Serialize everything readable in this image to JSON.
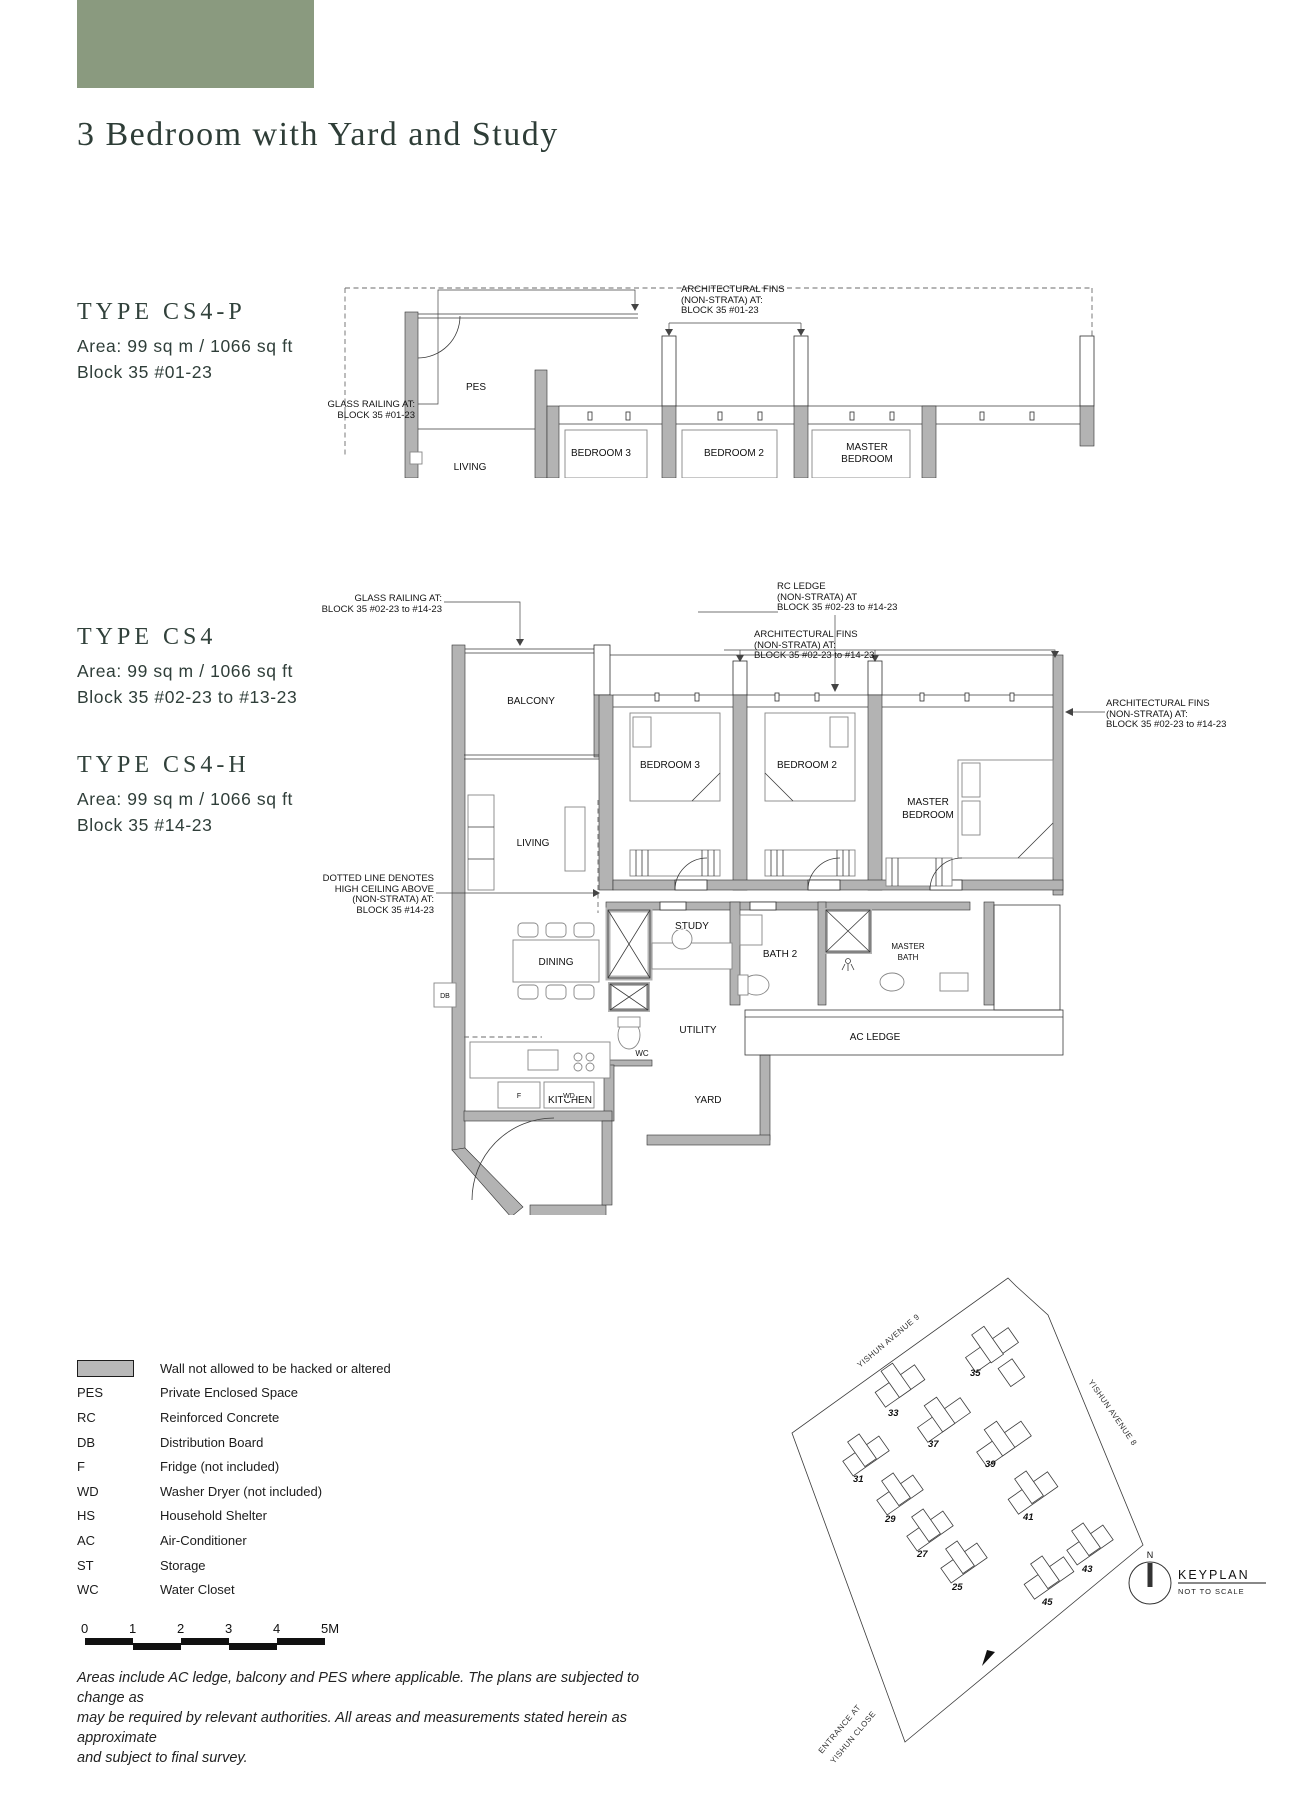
{
  "header": {
    "title": "3 Bedroom with Yard and Study",
    "accent_color": "#8a9a7f"
  },
  "types": {
    "cs4p": {
      "name": "TYPE CS4-P",
      "area": "Area: 99 sq m / 1066 sq ft",
      "block": "Block 35 #01-23"
    },
    "cs4": {
      "name": "TYPE CS4",
      "area": "Area: 99 sq m / 1066 sq ft",
      "block": "Block 35 #02-23 to #13-23"
    },
    "cs4h": {
      "name": "TYPE CS4-H",
      "area": "Area: 99 sq m / 1066 sq ft",
      "block": "Block 35 #14-23"
    }
  },
  "plan_top": {
    "rooms": {
      "pes": "PES",
      "living": "LIVING",
      "bedroom3": "BEDROOM 3",
      "bedroom2": "BEDROOM 2",
      "master1": "MASTER",
      "master2": "BEDROOM"
    },
    "ann": {
      "glass1": "GLASS RAILING AT:",
      "glass2": "BLOCK 35 #01-23",
      "fins1": "ARCHITECTURAL FINS",
      "fins2": "(NON-STRATA) AT:",
      "fins3": "BLOCK 35 #01-23"
    }
  },
  "plan_main": {
    "rooms": {
      "balcony": "BALCONY",
      "living": "LIVING",
      "dining": "DINING",
      "kitchen": "KITCHEN",
      "yard": "YARD",
      "utility": "UTILITY",
      "wc": "WC",
      "study": "STUDY",
      "bath2": "BATH 2",
      "masterbath1": "MASTER",
      "masterbath2": "BATH",
      "bedroom3": "BEDROOM 3",
      "bedroom2": "BEDROOM 2",
      "master1": "MASTER",
      "master2": "BEDROOM",
      "acledge": "AC LEDGE",
      "db": "DB",
      "f": "F",
      "wd": "WD"
    },
    "ann": {
      "glass1": "GLASS RAILING AT:",
      "glass2": "BLOCK 35 #02-23 to #14-23",
      "rc1": "RC LEDGE",
      "rc2": "(NON-STRATA) AT",
      "rc3": "BLOCK 35 #02-23 to #14-23",
      "finstop1": "ARCHITECTURAL FINS",
      "finstop2": "(NON-STRATA) AT:",
      "finstop3": "BLOCK 35 #02-23 to #14-23",
      "finsright1": "ARCHITECTURAL FINS",
      "finsright2": "(NON-STRATA) AT:",
      "finsright3": "BLOCK 35 #02-23 to #14-23",
      "dotted1": "DOTTED LINE DENOTES",
      "dotted2": "HIGH CEILING ABOVE",
      "dotted3": "(NON-STRATA) AT:",
      "dotted4": "BLOCK 35 #14-23"
    }
  },
  "legend": {
    "wall_note": "Wall not allowed to be hacked or altered",
    "items": [
      {
        "abbr": "PES",
        "desc": "Private Enclosed Space"
      },
      {
        "abbr": "RC",
        "desc": "Reinforced Concrete"
      },
      {
        "abbr": "DB",
        "desc": "Distribution Board"
      },
      {
        "abbr": "F",
        "desc": "Fridge (not included)"
      },
      {
        "abbr": "WD",
        "desc": "Washer Dryer (not included)"
      },
      {
        "abbr": "HS",
        "desc": "Household Shelter"
      },
      {
        "abbr": "AC",
        "desc": "Air-Conditioner"
      },
      {
        "abbr": "ST",
        "desc": "Storage"
      },
      {
        "abbr": "WC",
        "desc": "Water Closet"
      }
    ]
  },
  "scalebar": {
    "ticks": [
      "0",
      "1",
      "2",
      "3",
      "4",
      "5M"
    ]
  },
  "keyplan": {
    "title": "KEYPLAN",
    "subtitle": "NOT TO SCALE",
    "north": "N",
    "road9": "YISHUN AVENUE 9",
    "road8": "YISHUN AVENUE 8",
    "entrance1": "ENTRANCE AT",
    "entrance2": "YISHUN CLOSE",
    "blocks": [
      "25",
      "27",
      "29",
      "31",
      "33",
      "35",
      "37",
      "39",
      "41",
      "43",
      "45"
    ],
    "highlight_color": "#8fa183"
  },
  "footer": {
    "line1": "Areas include AC ledge, balcony and PES where applicable. The plans are subjected to change as",
    "line2": "may be required by relevant authorities. All areas and measurements stated herein as approximate",
    "line3": "and subject to final survey."
  }
}
